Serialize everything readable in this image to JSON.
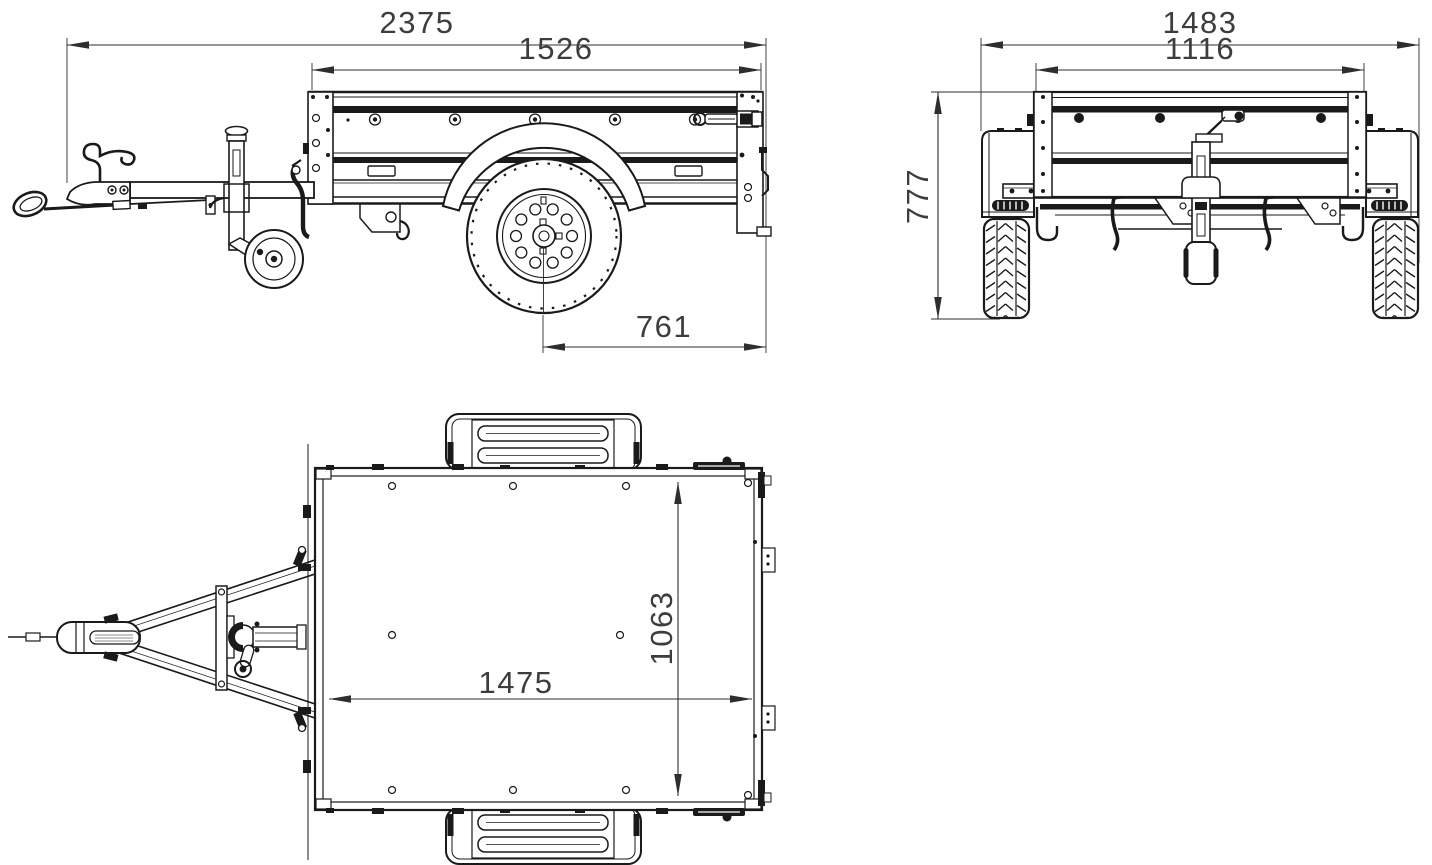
{
  "drawing": {
    "units": "mm",
    "background_color": "#ffffff",
    "line_color": "#1a1a1a",
    "dim_text_color": "#3d3d3d",
    "views": {
      "side": {
        "dims": {
          "overall_length": "2375",
          "bed_top_length": "1526",
          "wheel_center_to_rear": "761"
        }
      },
      "front": {
        "dims": {
          "overall_width": "1483",
          "body_width": "1116",
          "overall_height": "777"
        }
      },
      "top": {
        "dims": {
          "inner_length": "1475",
          "inner_width": "1063"
        }
      }
    }
  }
}
